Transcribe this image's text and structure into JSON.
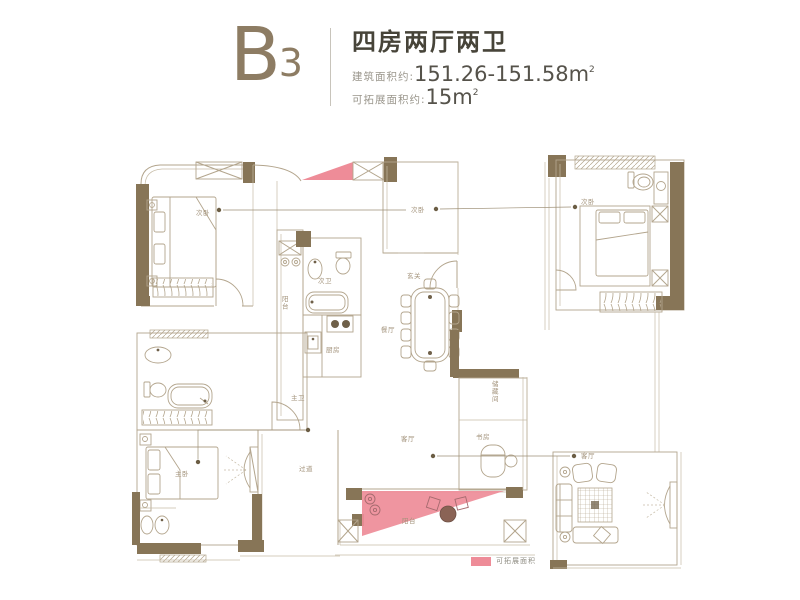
{
  "header": {
    "plan_code_letter": "B",
    "plan_code_number": "3",
    "title": "四房两厅两卫",
    "area_label": "建筑面积约:",
    "area_value": "151.26-151.58m",
    "area_sup": "2",
    "expand_label": "可拓展面积约:",
    "expand_value": "15m",
    "expand_sup": "2"
  },
  "legend": {
    "label": "可拓展面积",
    "swatch_color": "#ee8c98"
  },
  "colors": {
    "wall": "#877557",
    "line": "#b3a58d",
    "pink": "#ee8c98",
    "accent": "#8d7c63"
  },
  "plan": {
    "labels": [
      {
        "id": "bedroom-top-left",
        "text": "次卧",
        "x": 196,
        "y": 215
      },
      {
        "id": "bedroom-top-center",
        "text": "次卧",
        "x": 411,
        "y": 212
      },
      {
        "id": "bedroom-top-right",
        "text": "次卧",
        "x": 581,
        "y": 204
      },
      {
        "id": "balcony-left",
        "text": "阳台",
        "x": 282,
        "y": 301,
        "vertical": true
      },
      {
        "id": "bath-secondary",
        "text": "次卫",
        "x": 318,
        "y": 283
      },
      {
        "id": "kitchen",
        "text": "厨房",
        "x": 326,
        "y": 352
      },
      {
        "id": "foyer",
        "text": "玄关",
        "x": 407,
        "y": 278
      },
      {
        "id": "dining",
        "text": "餐厅",
        "x": 381,
        "y": 332
      },
      {
        "id": "bath-master",
        "text": "主卫",
        "x": 291,
        "y": 400
      },
      {
        "id": "bedroom-master",
        "text": "主卧",
        "x": 175,
        "y": 476
      },
      {
        "id": "hallway",
        "text": "过道",
        "x": 299,
        "y": 471
      },
      {
        "id": "living",
        "text": "客厅",
        "x": 401,
        "y": 441
      },
      {
        "id": "living-right",
        "text": "客厅",
        "x": 581,
        "y": 458
      },
      {
        "id": "study",
        "text": "书房",
        "x": 476,
        "y": 439
      },
      {
        "id": "storage",
        "text": "储藏间",
        "x": 492,
        "y": 386,
        "vertical": true
      },
      {
        "id": "balcony-bottom",
        "text": "阳台",
        "x": 402,
        "y": 523
      }
    ]
  }
}
